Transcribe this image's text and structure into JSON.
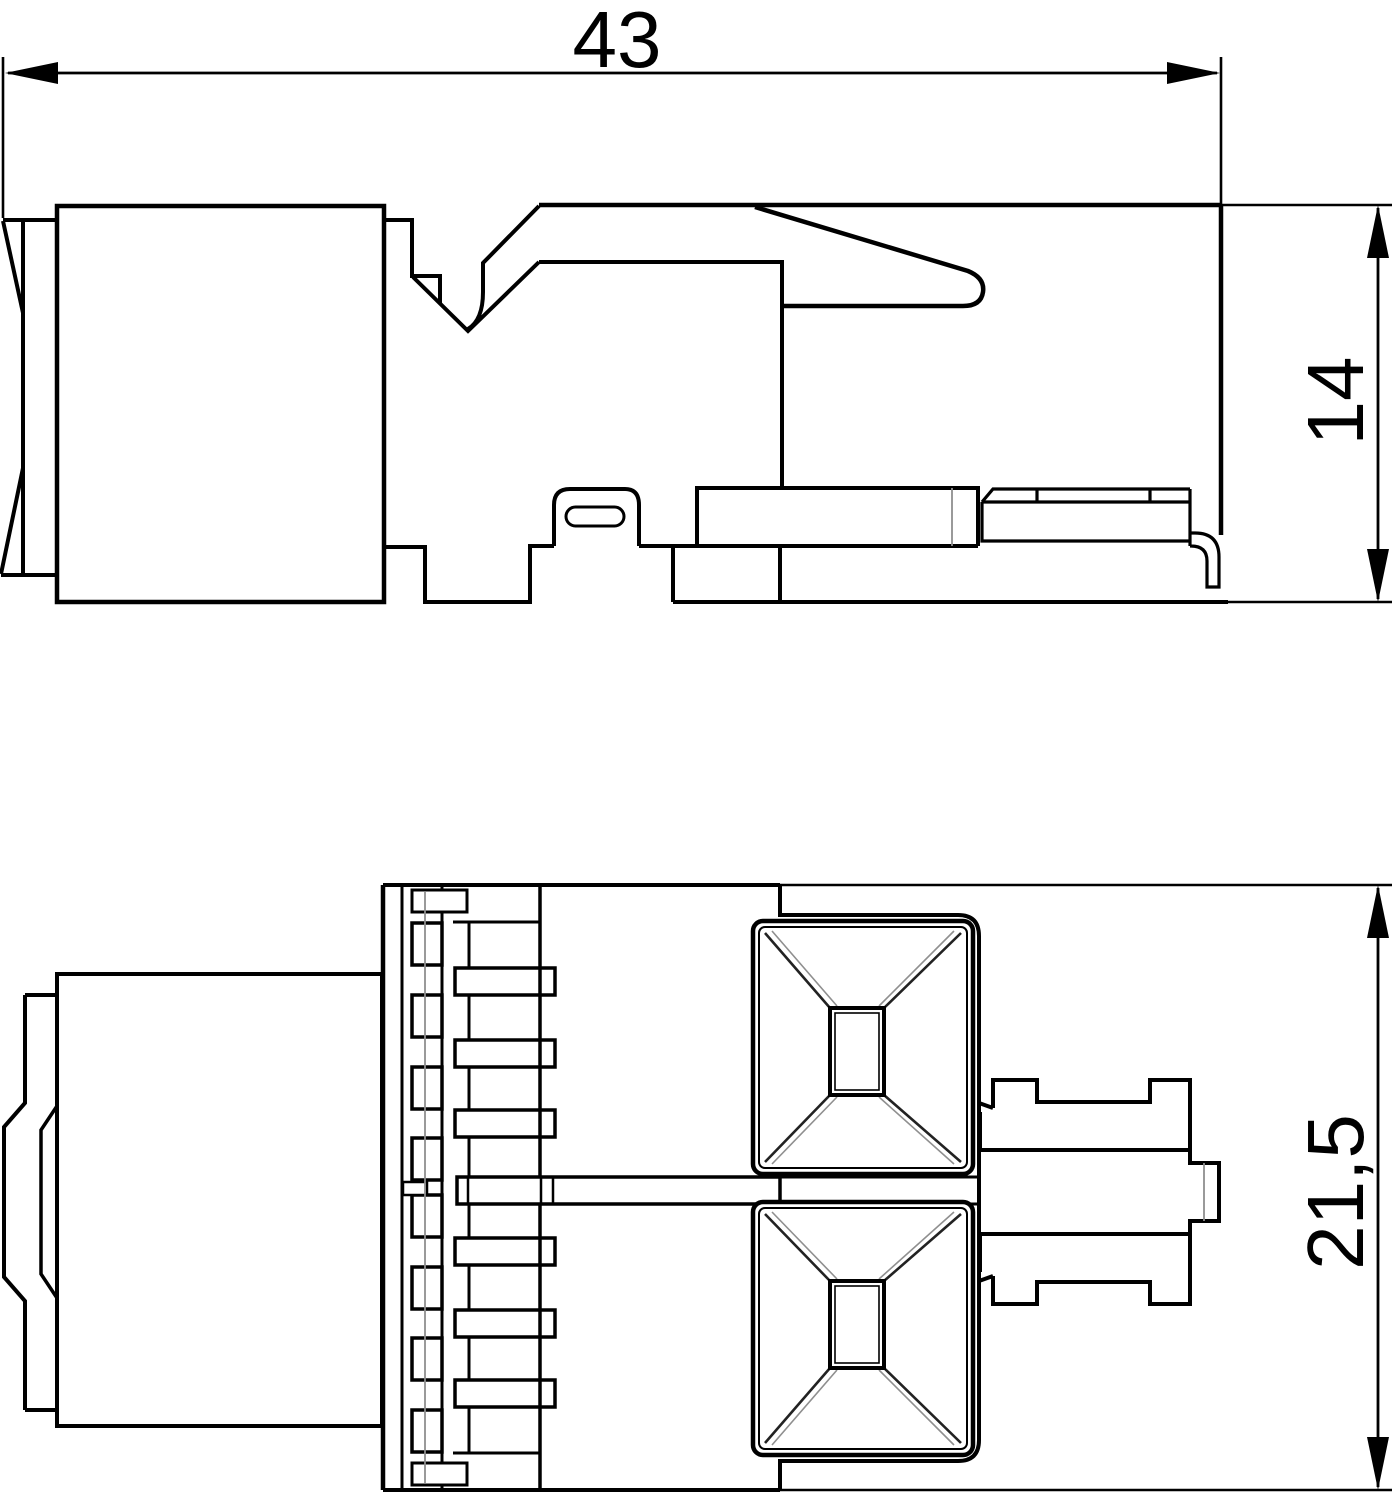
{
  "drawing": {
    "type": "dimensioned-technical-line-drawing",
    "background": "#ffffff",
    "line_color": "#000000",
    "thin_line_color": "#8f8f8f",
    "dimensions": [
      {
        "id": "length",
        "label": "43",
        "value": 43,
        "unit": "mm",
        "orientation": "horizontal",
        "view": "side-view"
      },
      {
        "id": "height",
        "label": "14",
        "value": 14,
        "unit": "mm",
        "orientation": "vertical",
        "view": "side-view"
      },
      {
        "id": "depth",
        "label": "21,5",
        "value": 21.5,
        "unit": "mm",
        "orientation": "vertical",
        "view": "front-view"
      }
    ]
  }
}
